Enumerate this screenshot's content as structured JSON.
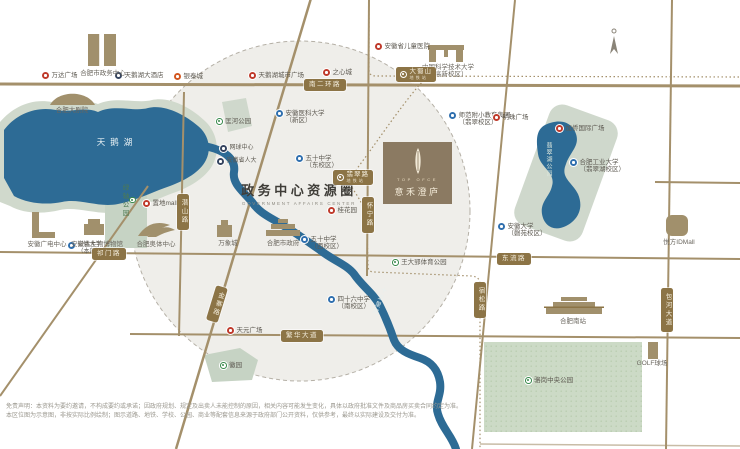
{
  "title": {
    "zh": "政务中心资源圈",
    "en": "GOVERNMENT AFFAIRS CENTER"
  },
  "logo": {
    "en": "TOP OFCE",
    "zh": "意禾澄庐"
  },
  "water": {
    "swan_lake": "天鹅湖",
    "river": "十五里河",
    "jade_lake": "翡翠湖公园"
  },
  "colors": {
    "road": "#a4906b",
    "pill": "#8c7446",
    "water": "#2d6b95",
    "park": "#cfd8cc",
    "circle_fill": "#efeeea",
    "logo_bg": "#8b7a62",
    "poi_red": "#bf3a2b",
    "poi_blue": "#2f6fae",
    "poi_green": "#3a8a4d",
    "poi_navy": "#35445f"
  },
  "pois": [
    {
      "n": "wanda-plaza",
      "t": "dot",
      "c": "red",
      "x": 42,
      "y": 72,
      "s": "万达广场"
    },
    {
      "n": "swan-lake-hotel",
      "t": "dot",
      "c": "navy",
      "x": 115,
      "y": 72,
      "s": "天鹅湖大酒店"
    },
    {
      "n": "yintai-city",
      "t": "dot",
      "c": "orange",
      "x": 174,
      "y": 73,
      "s": "银泰城"
    },
    {
      "n": "hefei-government-center",
      "t": "lbl",
      "x": 103,
      "y": 70,
      "s": "合肥市政务中心"
    },
    {
      "n": "hefei-grand-theatre",
      "t": "lbl",
      "x": 72,
      "y": 107,
      "s": "合肥大剧院"
    },
    {
      "n": "kuanghe-park",
      "t": "dot",
      "c": "green",
      "x": 216,
      "y": 118,
      "s": "匡河公园"
    },
    {
      "n": "tennis-center",
      "t": "dot",
      "c": "navy",
      "x": 220,
      "y": 145,
      "s": "网球中心",
      "sm": true
    },
    {
      "n": "provincial-peoples-congress",
      "t": "dot",
      "c": "navy",
      "x": 217,
      "y": 158,
      "s": "安徽省人大",
      "sm": true
    },
    {
      "n": "swan-lake-city-plaza",
      "t": "dot",
      "c": "red",
      "x": 249,
      "y": 72,
      "s": "天鹅湖城市广场"
    },
    {
      "n": "zhixin-city",
      "t": "dot",
      "c": "red",
      "x": 323,
      "y": 69,
      "s": "之心城"
    },
    {
      "n": "anhui-medical-university",
      "t": "dot",
      "c": "blue",
      "x": 276,
      "y": 110,
      "s": [
        "安徽医科大学",
        "（新区）"
      ]
    },
    {
      "n": "children-hospital",
      "t": "dot",
      "c": "red",
      "x": 375,
      "y": 43,
      "s": "安徽省儿童医院"
    },
    {
      "n": "ustc-hightech-campus",
      "t": "lbl",
      "x": 448,
      "y": 64,
      "s": [
        "中国科学技术大学",
        "（高新校区）"
      ]
    },
    {
      "n": "shifan-primary-school",
      "t": "dot",
      "c": "blue",
      "x": 449,
      "y": 112,
      "s": [
        "师范附小教育集团",
        "（翡翠校区）"
      ]
    },
    {
      "n": "mingzhu-plaza",
      "t": "dot",
      "c": "red",
      "x": 493,
      "y": 114,
      "s": "明珠广场"
    },
    {
      "n": "jiaqiao-international-plaza",
      "t": "dot",
      "c": "red",
      "x": 556,
      "y": 125,
      "s": "加侨国际广场"
    },
    {
      "n": "hfut-feicui-campus",
      "t": "dot",
      "c": "blue",
      "x": 570,
      "y": 159,
      "s": [
        "合肥工业大学",
        "（翡翠湖校区）"
      ]
    },
    {
      "n": "anhui-university-qingyuan",
      "t": "dot",
      "c": "blue",
      "x": 498,
      "y": 223,
      "s": [
        "安徽大学",
        "（磬苑校区）"
      ]
    },
    {
      "n": "yuefang-idmall",
      "t": "lbl",
      "x": 679,
      "y": 239,
      "s": "悦方IDMall"
    },
    {
      "n": "zhidi-mall",
      "t": "dot",
      "c": "red",
      "x": 143,
      "y": 200,
      "s": "置地mall"
    },
    {
      "n": "no50-middle-school-east",
      "t": "dot",
      "c": "blue",
      "x": 296,
      "y": 155,
      "s": [
        "五十中学",
        "（东校区）"
      ]
    },
    {
      "n": "guihuayuan",
      "t": "dot",
      "c": "red",
      "x": 328,
      "y": 207,
      "s": "桂花园"
    },
    {
      "n": "hefei-city-government",
      "t": "lbl",
      "x": 283,
      "y": 240,
      "s": "合肥市政府"
    },
    {
      "n": "no50-middle-school-west",
      "t": "dot",
      "c": "blue",
      "x": 301,
      "y": 236,
      "s": [
        "五十中学",
        "（西校区）"
      ]
    },
    {
      "n": "no46-middle-school",
      "t": "dot",
      "c": "blue",
      "x": 328,
      "y": 296,
      "s": [
        "四十六中学",
        "（南校区）"
      ]
    },
    {
      "n": "anhui-broadcasting-center",
      "t": "lbl",
      "x": 47,
      "y": 241,
      "s": "安徽广电中心"
    },
    {
      "n": "anhui-university-main",
      "t": "dot",
      "c": "blue",
      "x": 68,
      "y": 242,
      "s": [
        "安徽大学",
        "（本部）"
      ],
      "sm": true
    },
    {
      "n": "paleontology-museum",
      "t": "lbl",
      "x": 97,
      "y": 241,
      "s": "安徽古生物博物馆"
    },
    {
      "n": "hefei-olympic-center",
      "t": "lbl",
      "x": 156,
      "y": 241,
      "s": "合肥奥体中心"
    },
    {
      "n": "mixc-mall",
      "t": "lbl",
      "x": 228,
      "y": 240,
      "s": "万象城"
    },
    {
      "n": "tianyuan-plaza",
      "t": "dot",
      "c": "red",
      "x": 227,
      "y": 327,
      "s": "天元广场"
    },
    {
      "n": "hui-garden",
      "t": "dot",
      "c": "green",
      "x": 220,
      "y": 362,
      "s": "徽园"
    },
    {
      "n": "wangdaying-sports-park",
      "t": "dot",
      "c": "green",
      "x": 392,
      "y": 259,
      "s": "王大郢体育公园"
    },
    {
      "n": "hefei-south-station",
      "t": "lbl",
      "x": 573,
      "y": 318,
      "s": "合肥南站"
    },
    {
      "n": "luogang-central-park",
      "t": "dot",
      "c": "green",
      "x": 525,
      "y": 377,
      "s": "骆岗中央公园"
    },
    {
      "n": "golf-course",
      "t": "lbl",
      "x": 652,
      "y": 360,
      "s": "GOLF球场"
    }
  ],
  "road_pills": [
    {
      "n": "road-south-2nd-ring",
      "t": "pillh",
      "x": 304,
      "y": 79,
      "s": "南二环路"
    },
    {
      "n": "road-qimen",
      "t": "pillh",
      "x": 92,
      "y": 248,
      "s": "祁门路"
    },
    {
      "n": "road-dongliu",
      "t": "pillh",
      "x": 497,
      "y": 253,
      "s": "东流路"
    },
    {
      "n": "road-fanhua-avenue",
      "t": "pillh",
      "x": 281,
      "y": 330,
      "s": "繁华大道"
    },
    {
      "n": "road-qianshan",
      "t": "pillv",
      "x": 177,
      "y": 194,
      "s": "潜山路"
    },
    {
      "n": "road-huaining",
      "t": "pillv",
      "x": 362,
      "y": 197,
      "s": "怀宁路"
    },
    {
      "n": "road-jinzhai",
      "t": "pilld",
      "x": 211,
      "y": 286,
      "s": "金寨路"
    },
    {
      "n": "road-susong",
      "t": "pillv",
      "x": 474,
      "y": 282,
      "s": "宿松路"
    },
    {
      "n": "road-baohe-avenue",
      "t": "pillv",
      "x": 661,
      "y": 288,
      "s": "包河大道"
    }
  ],
  "metro_stations": [
    {
      "n": "metro-station-dashushan",
      "x": 396,
      "y": 67,
      "s": "大蜀山",
      "sub": "地铁站"
    },
    {
      "n": "metro-station-feicuilu",
      "x": 333,
      "y": 170,
      "s": "翡翠路",
      "sub": "地铁站"
    }
  ],
  "park_labels": [
    {
      "n": "green-axis-park",
      "x": 119,
      "y": 184,
      "s": "绿轴公园"
    }
  ],
  "disclaimer": [
    "免责声明：本资料为要约邀请，不构成要约或承诺；因政府规划、规定及出卖人未能控制的原因，相关内容可能发生变化，具体以政府批准文件及商品房买卖合同约定为准。",
    "本区位图为示意图，非按实际比例绘制；图示道路、地铁、学校、公园、商业等配套信息来源于政府部门公开资料，仅供参考，最终以实际建设及交付为准。"
  ]
}
